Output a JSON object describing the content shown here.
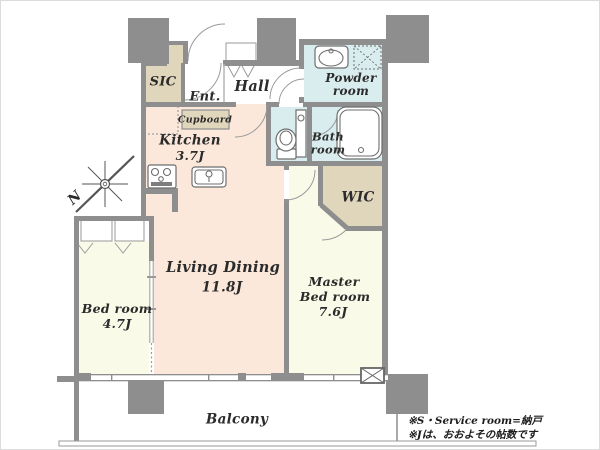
{
  "rooms": {
    "sic": {
      "label": "SIC"
    },
    "entrance": {
      "label": "Ent."
    },
    "hall": {
      "label": "Hall"
    },
    "cupboard": {
      "label": "Cupboard"
    },
    "kitchen": {
      "label": "Kitchen",
      "size": "3.7J"
    },
    "powder_room": {
      "label_line1": "Powder",
      "label_line2": "room"
    },
    "bath_room": {
      "label_line1": "Bath",
      "label_line2": "room"
    },
    "wic": {
      "label": "WIC"
    },
    "living_dining": {
      "label": "Living Dining",
      "size": "11.8J"
    },
    "master_bedroom": {
      "label_line1": "Master",
      "label_line2": "Bed room",
      "size": "7.6J"
    },
    "bedroom": {
      "label": "Bed room",
      "size": "4.7J"
    },
    "balcony": {
      "label": "Balcony"
    }
  },
  "compass": {
    "north_label": "N"
  },
  "footnotes": {
    "line1": "※S・Service room=納戸",
    "line2": "※Jは、おおよその帖数です"
  },
  "colors": {
    "wall": "#8e8e8e",
    "ldk_floor": "#fbe8db",
    "bedroom_floor": "#fafae9",
    "closet_floor": "#e0d6bb",
    "wet_floor": "#d9edef",
    "label_text": "#2b2b2b",
    "fixture": "#6e6e6e"
  }
}
